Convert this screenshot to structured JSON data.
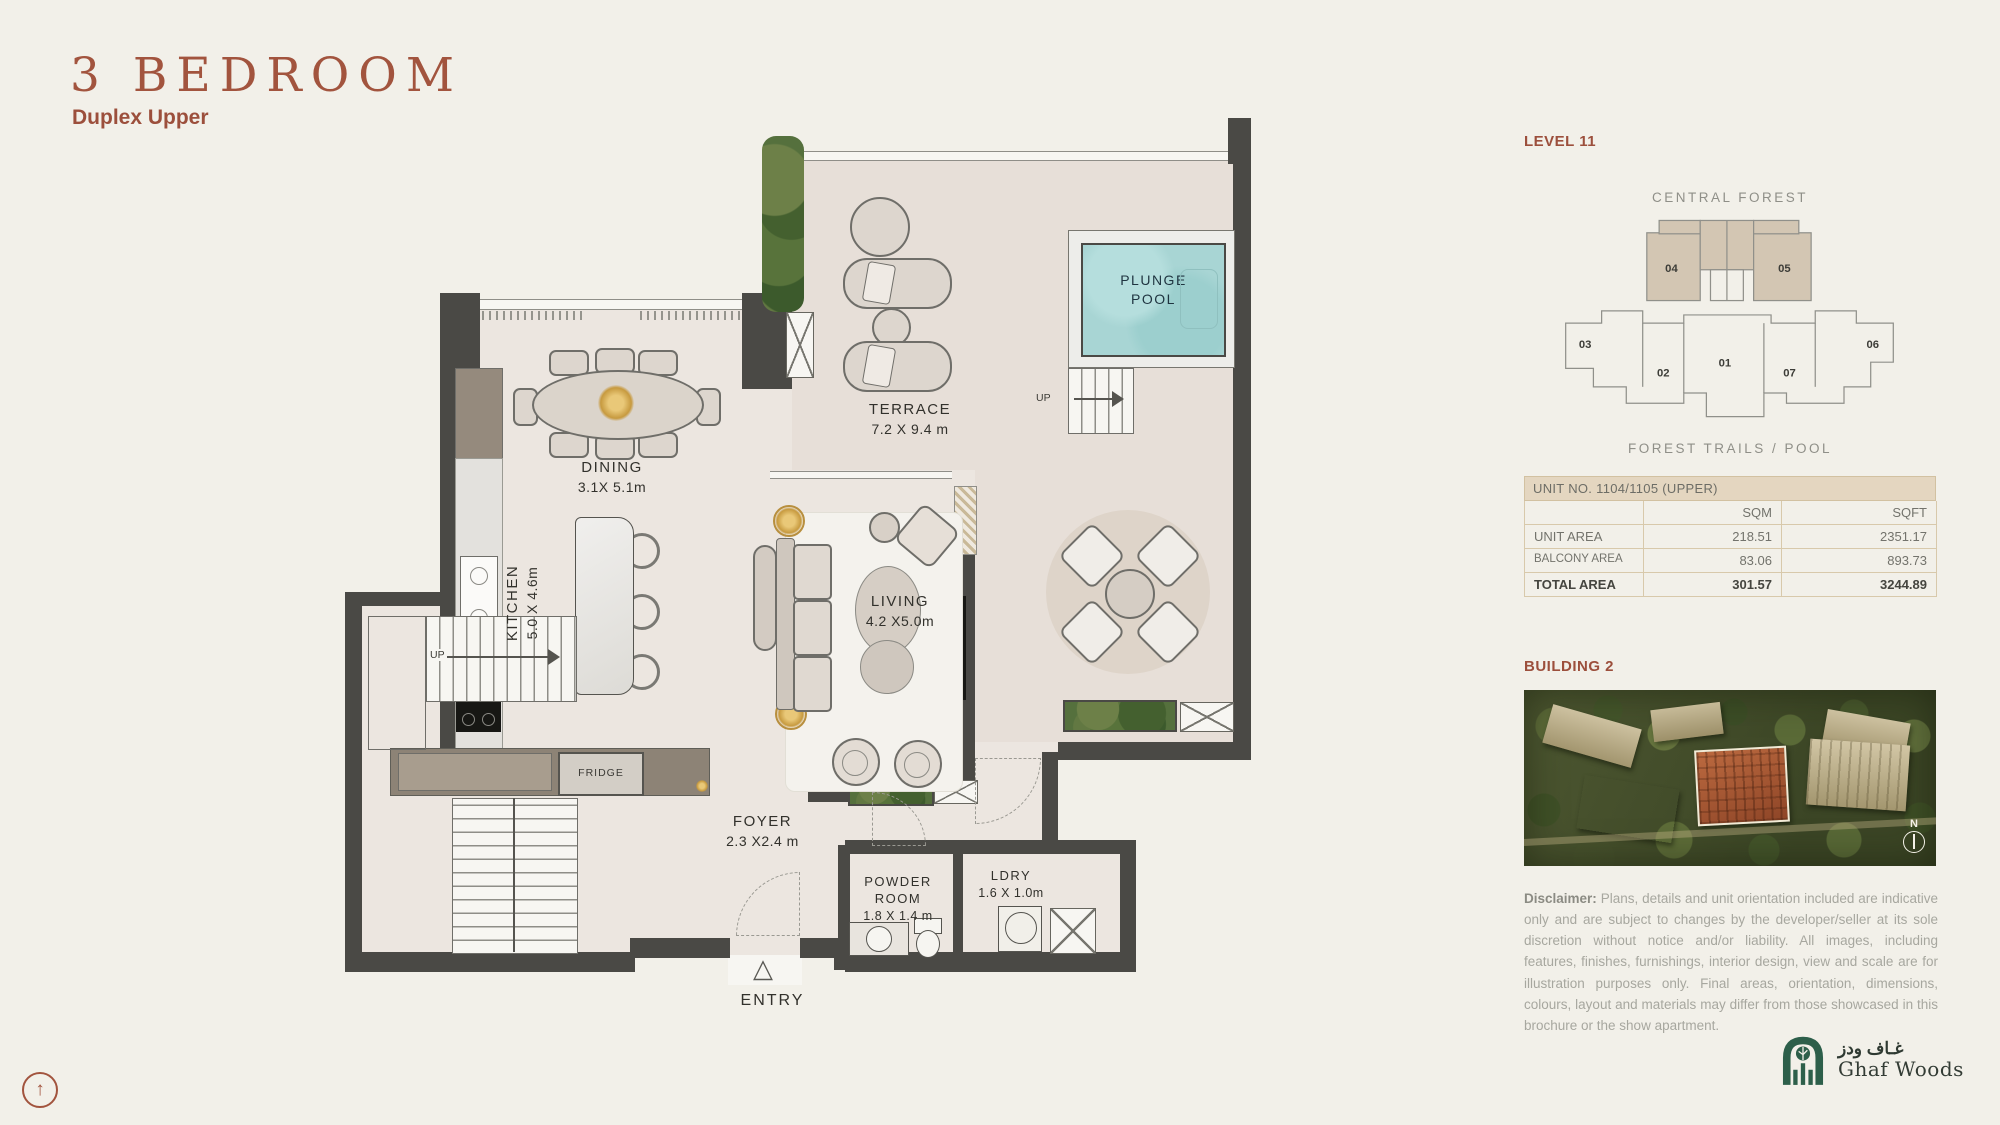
{
  "header": {
    "title": "3 BEDROOM",
    "subtitle": "Duplex Upper"
  },
  "plan": {
    "terrace": {
      "name": "TERRACE",
      "dims": "7.2 X 9.4 m"
    },
    "pool": {
      "line1": "PLUNGE",
      "line2": "POOL"
    },
    "dining": {
      "name": "DINING",
      "dims": "3.1X 5.1m"
    },
    "kitchen": {
      "name": "KITCHEN",
      "dims": "5.0 X 4.6m"
    },
    "living": {
      "name": "LIVING",
      "dims": "4.2 X5.0m"
    },
    "foyer": {
      "name": "FOYER",
      "dims": "2.3 X2.4 m"
    },
    "powder": {
      "line1": "POWDER",
      "line2": "ROOM",
      "dims": "1.8 X 1.4 m"
    },
    "ldry": {
      "name": "LDRY",
      "dims": "1.6 X 1.0m"
    },
    "entry": "ENTRY",
    "fridge": "FRIDGE",
    "up_pool": "UP",
    "up_stairs": "UP"
  },
  "panel": {
    "level": "LEVEL 11",
    "site": {
      "top_label": "CENTRAL FOREST",
      "bottom_label": "FOREST TRAILS / POOL",
      "units": [
        "01",
        "02",
        "03",
        "04",
        "05",
        "06",
        "07"
      ],
      "highlighted_units": [
        "04",
        "05"
      ],
      "highlight_color": "#d3c6b3"
    },
    "table": {
      "title": "UNIT NO.  1104/1105 (UPPER)",
      "col_sqm": "SQM",
      "col_sqft": "SQFT",
      "rows": [
        {
          "label": "UNIT AREA",
          "sqm": "218.51",
          "sqft": "2351.17"
        },
        {
          "label": "BALCONY AREA",
          "sqm": "83.06",
          "sqft": "893.73"
        },
        {
          "label": "TOTAL AREA",
          "sqm": "301.57",
          "sqft": "3244.89"
        }
      ]
    },
    "building_label": "BUILDING 2",
    "compass": "N",
    "disclaimer": {
      "label": "Disclaimer:",
      "text": " Plans, details and unit orientation included are indicative only and are subject to changes by the developer/seller at its sole discretion without notice and/or liability. All images, including features, finishes, furnishings, interior design, view and scale are for illustration purposes only. Final areas, orientation, dimensions, colours, layout and materials may differ from those showcased in this brochure or the show apartment."
    },
    "logo": {
      "arabic": "غـاف ودز",
      "name": "Ghaf Woods"
    }
  },
  "accent_color": "#a2543e",
  "pool_color": "#a8d5d4"
}
